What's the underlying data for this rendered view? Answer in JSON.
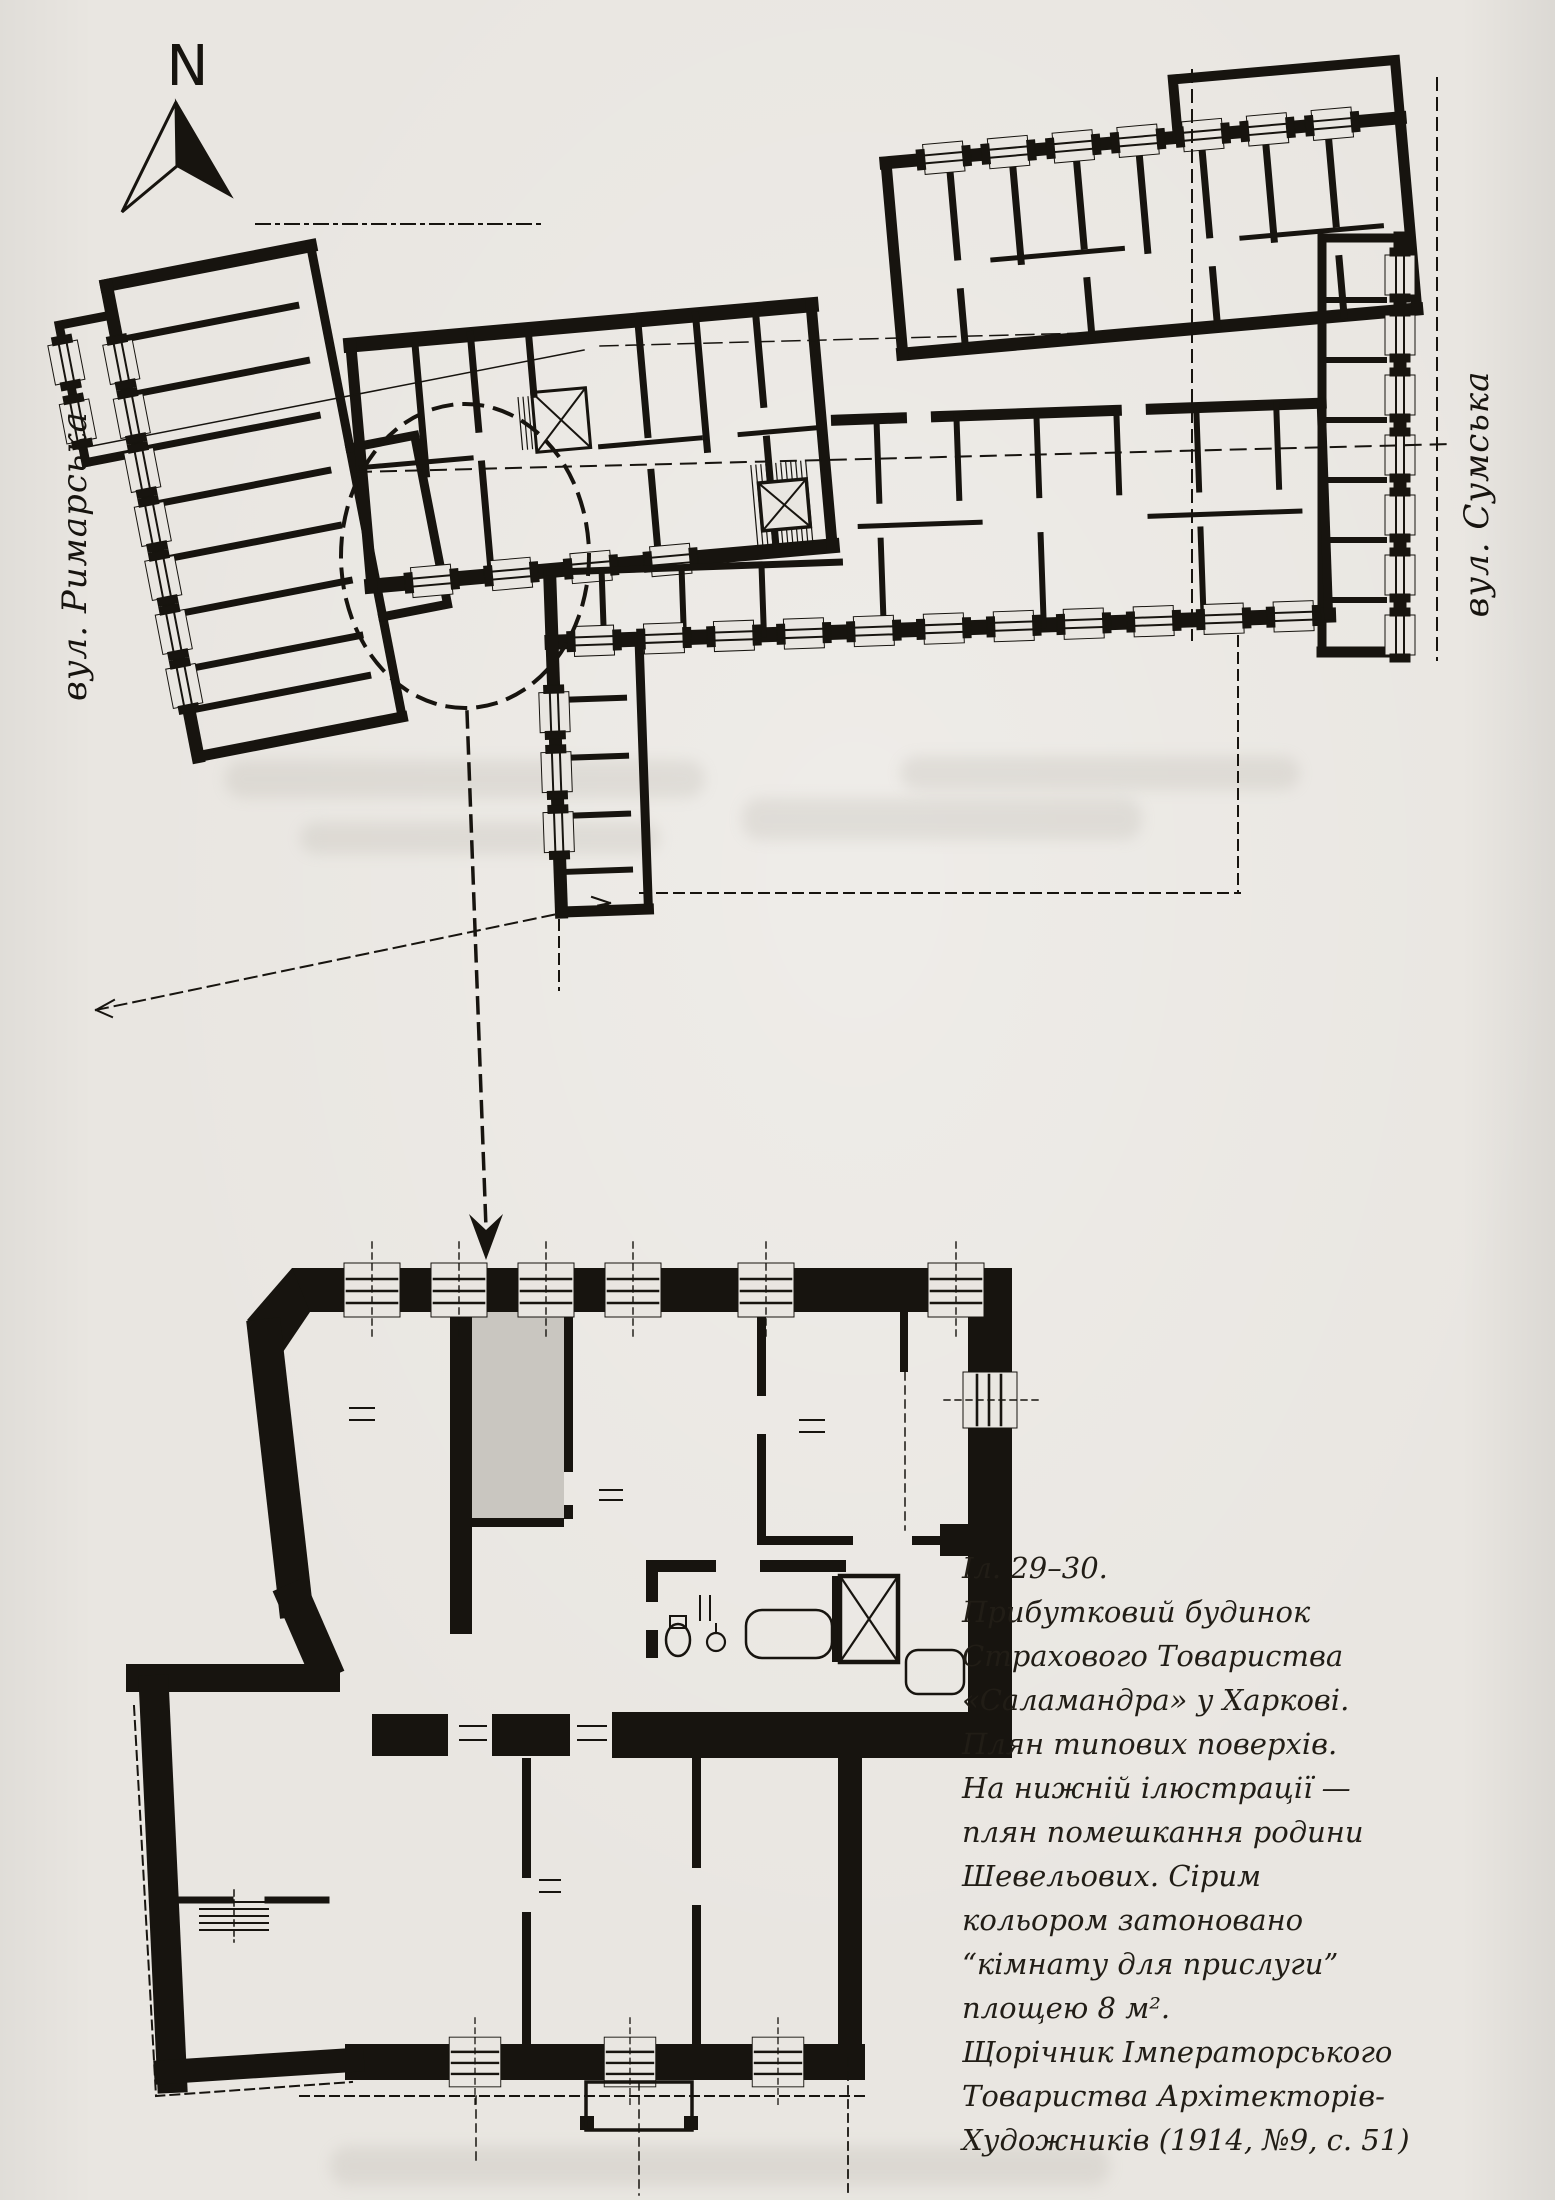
{
  "page": {
    "paper_color": "#e9e6e1",
    "ink_color": "#17140f",
    "shaded_room_color": "#c9c6c0"
  },
  "compass": {
    "label": "N"
  },
  "street_labels": {
    "left": "вул. Римарська",
    "right": "вул. Сумська"
  },
  "caption": {
    "lines": [
      "Іл. 29–30.",
      "Прибутковий будинок",
      "Страхового Товариства",
      "«Саламандра» у Харкові.",
      "Плян типових поверхів.",
      "На нижній ілюстрації —",
      "плян помешкання родини",
      "Шевельових. Сірим",
      "кольором затоновано",
      "“кімнату для прислуги”",
      "площею 8 м².",
      "Щорічник Імператорського",
      "Товариства Архітекторів-",
      "Художників (1914, №9, с. 51)"
    ]
  }
}
